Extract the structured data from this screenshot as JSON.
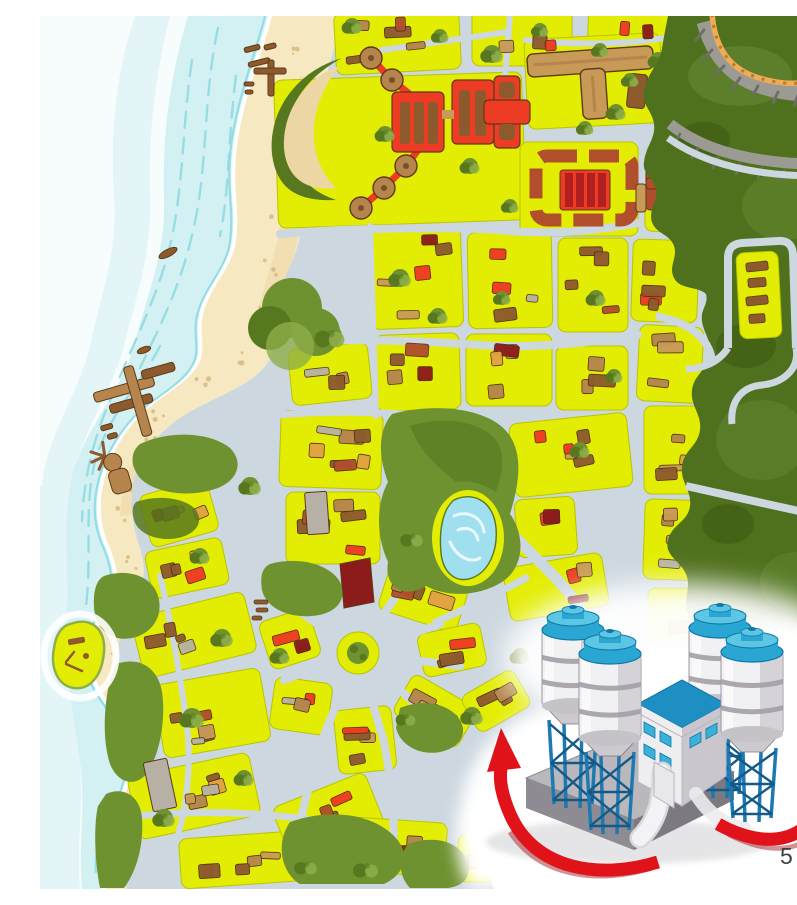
{
  "page": {
    "number": "5"
  },
  "figure": {
    "type": "illustrated-city-map",
    "inset_illustration": "concrete-plant",
    "silo_count": 4,
    "arrow_count": 2,
    "arrows": [
      "rotation-arrow-left",
      "rotation-arrow-right"
    ]
  },
  "palette": {
    "paper": "#ffffff",
    "seaFar": "#f7fcfc",
    "seaNear": "#cdeef1",
    "wave": "#8ed9e2",
    "foam": "#ffffff",
    "sand": "#f6e8c1",
    "sandDark": "#ecd6a4",
    "speckle": "#d9b97f",
    "road": "#ccd7df",
    "block": "#e3ed04",
    "blockEdge": "#b9c400",
    "park": "#6f9230",
    "parkDark": "#57781f",
    "parkLight": "#8fae49",
    "forest": "#4f701c",
    "forestDark": "#3e5a12",
    "forestLight": "#648531",
    "cliff": "#9b9b94",
    "cliffDark": "#6e6e66",
    "orangeRoad": "#efab55",
    "orangeRoadDark": "#b97a2e",
    "lake": "#9fdfee",
    "lakeLight": "#eaf8fb",
    "brown": "#8d5a2e",
    "brownDark": "#5e3a18",
    "tan": "#b5854d",
    "tanLight": "#c89a58",
    "red": "#ee3b23",
    "crimson": "#b02020",
    "rust": "#b14e2c",
    "maroon": "#8c1b1b",
    "orange": "#e2a243",
    "grayBldg": "#b6b1a4",
    "silo": "#f1f0f3",
    "siloShade": "#ccc9cf",
    "siloBand": "#a49ea6",
    "blueTop": "#2aa6d2",
    "blueLight": "#5cc6e4",
    "blueDark": "#1077a6",
    "lattice": "#1d79b2",
    "latticeDark": "#135a88",
    "wall": "#eeedf0",
    "wallShade": "#c9c7cd",
    "roof": "#1e8fc3",
    "windowBlue": "#39b1d8",
    "baseTop": "#bab7bd",
    "baseSide": "#8e8b92",
    "baseDark": "#7c7980",
    "arrow": "#e0131a",
    "arrowDark": "#9c0d11",
    "pageNum": "#3f3f41"
  }
}
